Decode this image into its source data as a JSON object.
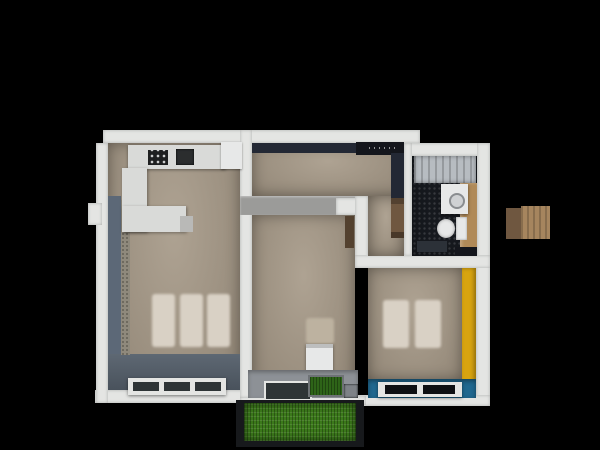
{
  "scene": {
    "description": "top-down 3d render of an apartment floor plan on black background",
    "background": "#000000"
  },
  "colors": {
    "wall": "#e4e5e3",
    "inner_wall_grey": "#9b9b99",
    "floor": "#a59886",
    "floor_dark_band": "#5e6873",
    "blue_grey_wall": "#5c6877",
    "texture_strip": "#8f897c",
    "dark_navy": "#232834",
    "near_black": "#14161c",
    "bath_floor": "#16191e",
    "counter_white": "#d9dad8",
    "appliance_dark": "#1e1f20",
    "sink_dark": "#2b2d2e",
    "fixture_white": "#e7e8e8",
    "tub_grey": "#b7bcc1",
    "wood": "#b08a58",
    "wood_dark": "#6f5740",
    "wood_light": "#a6855e",
    "door_brown": "#53412f",
    "yellow": "#d8a410",
    "teal": "#20688f",
    "ledge_grey": "#8d9196",
    "glass_dark": "#2e3436",
    "soft_panel": "#d9d1c5",
    "grass": "#3c7a1b",
    "planter_green": "#2e6418",
    "frame_dark": "#17191c",
    "mat_dark": "#2c3138"
  },
  "objects": {
    "rooms": [
      "kitchen-living-room",
      "hallway",
      "bathroom",
      "middle-room",
      "right-bedroom",
      "balcony"
    ],
    "furniture": [
      "kitchen-counter",
      "cooktop",
      "kitchen-sink",
      "tall-cabinet",
      "island-counter",
      "bed-panels-left",
      "floor-window-left",
      "hall-wardrobe",
      "hall-shelf",
      "bathtub",
      "washing-machine",
      "bath-wood-counter",
      "toilet",
      "bath-mat",
      "chair",
      "window-sill-glass",
      "grass-planter",
      "bed-panels-right",
      "window-right",
      "grass-patch",
      "loose-wood-box"
    ]
  }
}
